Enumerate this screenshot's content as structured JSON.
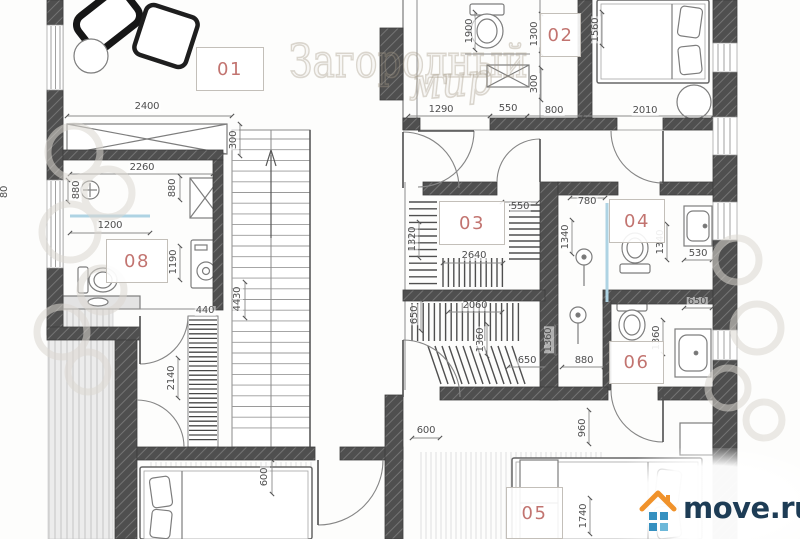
{
  "colors": {
    "room_label": "#b3524d",
    "wall": "#4a4a4a",
    "drawing_line": "#8a8a8a",
    "dimension_text": "#4f4f4f",
    "glass": "#aed3e3",
    "watermark": "#d6d2ca",
    "logo_text": "#1d3c55",
    "logo_roof": "#f0922b",
    "logo_window": "#3590c0"
  },
  "watermark": {
    "word1": "Загородный",
    "word2": "мир"
  },
  "logo": {
    "text": "move.ru"
  },
  "rooms": [
    {
      "label": "01",
      "x": 196,
      "y": 47,
      "w": 68,
      "h": 44
    },
    {
      "label": "02",
      "x": 540,
      "y": 13,
      "w": 41,
      "h": 44
    },
    {
      "label": "03",
      "x": 439,
      "y": 201,
      "w": 66,
      "h": 44
    },
    {
      "label": "04",
      "x": 609,
      "y": 199,
      "w": 56,
      "h": 44
    },
    {
      "label": "05",
      "x": 506,
      "y": 487,
      "w": 57,
      "h": 52
    },
    {
      "label": "06",
      "x": 609,
      "y": 341,
      "w": 55,
      "h": 43
    },
    {
      "label": "08",
      "x": 106,
      "y": 239,
      "w": 62,
      "h": 44
    }
  ],
  "dimensions": [
    {
      "text": "2400",
      "x": 147,
      "y": 107,
      "vertical": false
    },
    {
      "text": "300",
      "x": 234,
      "y": 140,
      "vertical": true
    },
    {
      "text": "2260",
      "x": 142,
      "y": 168,
      "vertical": false
    },
    {
      "text": "880",
      "x": 77,
      "y": 190,
      "vertical": true
    },
    {
      "text": "880",
      "x": 173,
      "y": 188,
      "vertical": true
    },
    {
      "text": "80",
      "x": 5,
      "y": 192,
      "vertical": true
    },
    {
      "text": "1200",
      "x": 110,
      "y": 226,
      "vertical": false
    },
    {
      "text": "1190",
      "x": 174,
      "y": 262,
      "vertical": true
    },
    {
      "text": "440",
      "x": 205,
      "y": 311,
      "vertical": false
    },
    {
      "text": "4430",
      "x": 238,
      "y": 299,
      "vertical": true
    },
    {
      "text": "2140",
      "x": 172,
      "y": 378,
      "vertical": true
    },
    {
      "text": "1290",
      "x": 441,
      "y": 110,
      "vertical": false
    },
    {
      "text": "550",
      "x": 508,
      "y": 109,
      "vertical": false
    },
    {
      "text": "800",
      "x": 554,
      "y": 111,
      "vertical": false
    },
    {
      "text": "2010",
      "x": 645,
      "y": 111,
      "vertical": false
    },
    {
      "text": "1900",
      "x": 470,
      "y": 31,
      "vertical": true
    },
    {
      "text": "1300",
      "x": 535,
      "y": 34,
      "vertical": true
    },
    {
      "text": "300",
      "x": 535,
      "y": 84,
      "vertical": true
    },
    {
      "text": "1560",
      "x": 596,
      "y": 30,
      "vertical": true
    },
    {
      "text": "1320",
      "x": 413,
      "y": 239,
      "vertical": true
    },
    {
      "text": "550",
      "x": 520,
      "y": 207,
      "vertical": false
    },
    {
      "text": "2640",
      "x": 474,
      "y": 256,
      "vertical": false
    },
    {
      "text": "780",
      "x": 587,
      "y": 202,
      "vertical": false
    },
    {
      "text": "1340",
      "x": 566,
      "y": 237,
      "vertical": true
    },
    {
      "text": "1340",
      "x": 661,
      "y": 242,
      "vertical": true
    },
    {
      "text": "530",
      "x": 698,
      "y": 254,
      "vertical": false
    },
    {
      "text": "650",
      "x": 415,
      "y": 315,
      "vertical": true
    },
    {
      "text": "2060",
      "x": 475,
      "y": 306,
      "vertical": false
    },
    {
      "text": "1360",
      "x": 481,
      "y": 340,
      "vertical": true
    },
    {
      "text": "650",
      "x": 527,
      "y": 361,
      "vertical": false
    },
    {
      "text": "1360",
      "x": 549,
      "y": 340,
      "vertical": true
    },
    {
      "text": "880",
      "x": 584,
      "y": 361,
      "vertical": false
    },
    {
      "text": "1360",
      "x": 657,
      "y": 338,
      "vertical": true
    },
    {
      "text": "650",
      "x": 697,
      "y": 302,
      "vertical": false
    },
    {
      "text": "600",
      "x": 426,
      "y": 431,
      "vertical": false
    },
    {
      "text": "960",
      "x": 583,
      "y": 428,
      "vertical": true
    },
    {
      "text": "600",
      "x": 265,
      "y": 477,
      "vertical": true
    },
    {
      "text": "1740",
      "x": 584,
      "y": 516,
      "vertical": true
    }
  ]
}
